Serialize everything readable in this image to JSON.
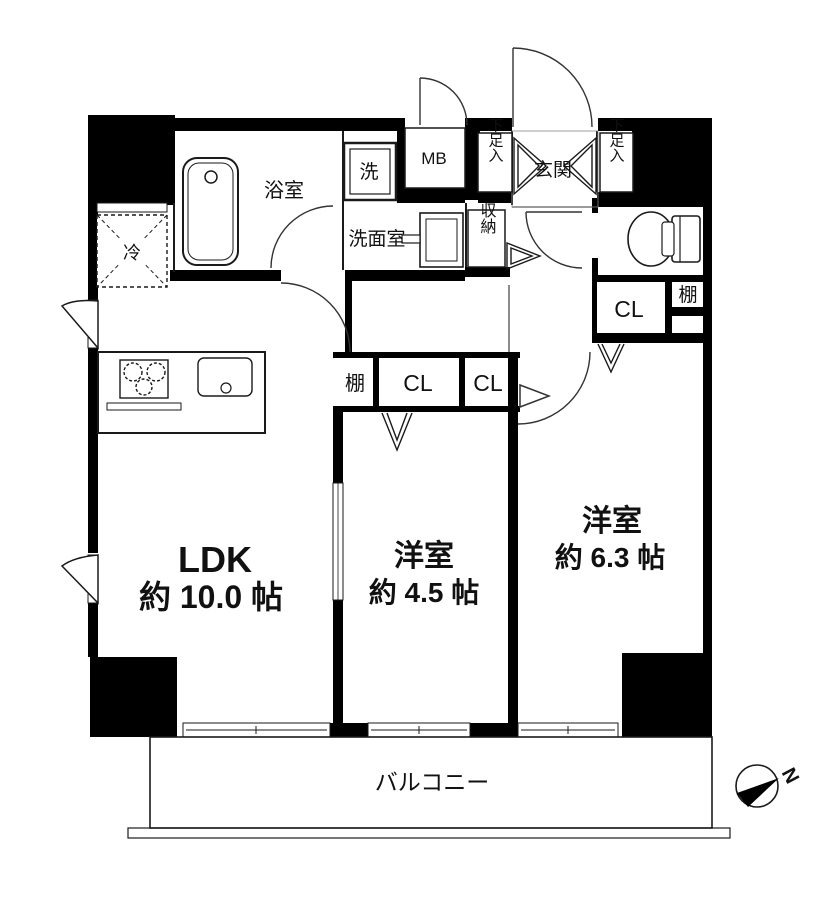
{
  "floorplan": {
    "rooms": {
      "ldk": {
        "label": "LDK",
        "size": "約 10.0 帖"
      },
      "bedroom_small": {
        "label": "洋室",
        "size": "約 4.5 帖"
      },
      "bedroom_large": {
        "label": "洋室",
        "size": "約 6.3 帖"
      },
      "balcony": {
        "label": "バルコニー"
      },
      "bathroom": {
        "label": "浴室"
      },
      "washroom": {
        "label": "洗面室"
      },
      "entrance": {
        "label": "玄関"
      }
    },
    "fixtures": {
      "washer_pan": "洗",
      "meter_box": "MB",
      "shoe_cabinet_left": "下足入",
      "shoe_cabinet_right": "下足入",
      "storage": "収納",
      "refrigerator": "冷",
      "shelf_middle": "棚",
      "shelf_right": "棚",
      "closet_middle_left": "CL",
      "closet_middle_right": "CL",
      "closet_bedroom_large": "CL"
    },
    "compass": {
      "north": "N"
    },
    "colors": {
      "wall": "#000000",
      "background": "#ffffff",
      "line": "#1a1a1a"
    }
  }
}
